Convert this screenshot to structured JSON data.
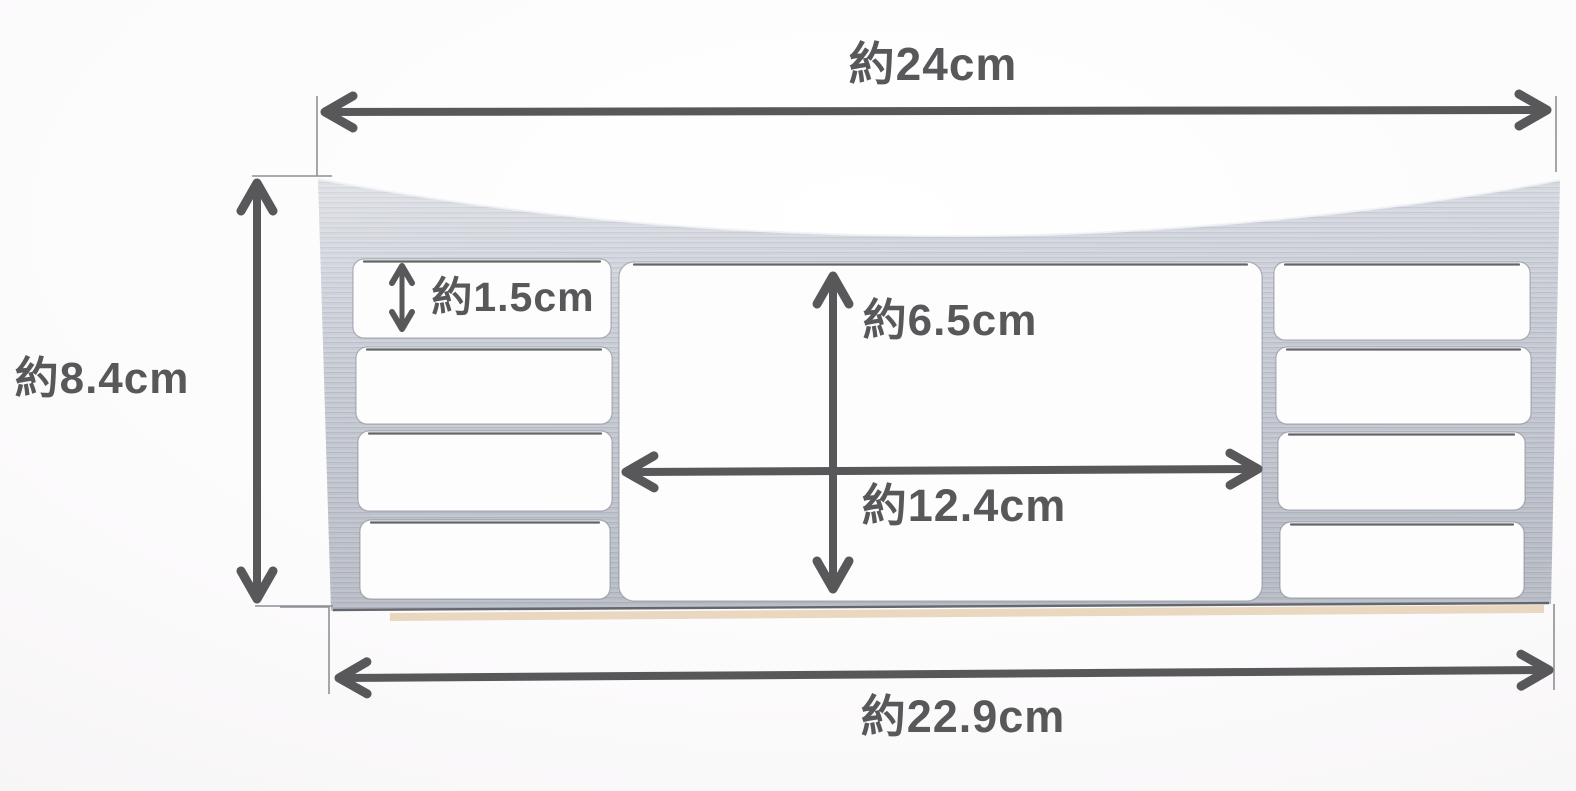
{
  "figure": {
    "kind": "product dimension diagram",
    "subject": "brushed-metal panel trim plate with punched-out openings (4 left slots, 1 large center opening, 4 right slots)"
  },
  "dimensions": {
    "top_width": {
      "label": "約24cm",
      "cm": 24,
      "orientation": "horizontal",
      "measures": "overall width (top)"
    },
    "left_height": {
      "label": "約8.4cm",
      "cm": 8.4,
      "orientation": "vertical",
      "measures": "overall height (left side)"
    },
    "small_cutout_height": {
      "label": "約1.5cm",
      "cm": 1.5,
      "orientation": "vertical",
      "measures": "height of small slot opening"
    },
    "center_cutout_height": {
      "label": "約6.5cm",
      "cm": 6.5,
      "orientation": "vertical",
      "measures": "height of center opening"
    },
    "center_cutout_width": {
      "label": "約12.4cm",
      "cm": 12.4,
      "orientation": "horizontal",
      "measures": "width of center opening"
    },
    "bottom_width": {
      "label": "約22.9cm",
      "cm": 22.9,
      "orientation": "horizontal",
      "measures": "overall width (bottom)"
    }
  },
  "colors": {
    "annotation": "#58585a",
    "extension_line": "#8d9096",
    "metal_base": "#c6cad3",
    "cutout_fill": "#fdfdfe",
    "bottom_edge_tan": "#e8d5bd",
    "background": "#f8f6f7"
  }
}
